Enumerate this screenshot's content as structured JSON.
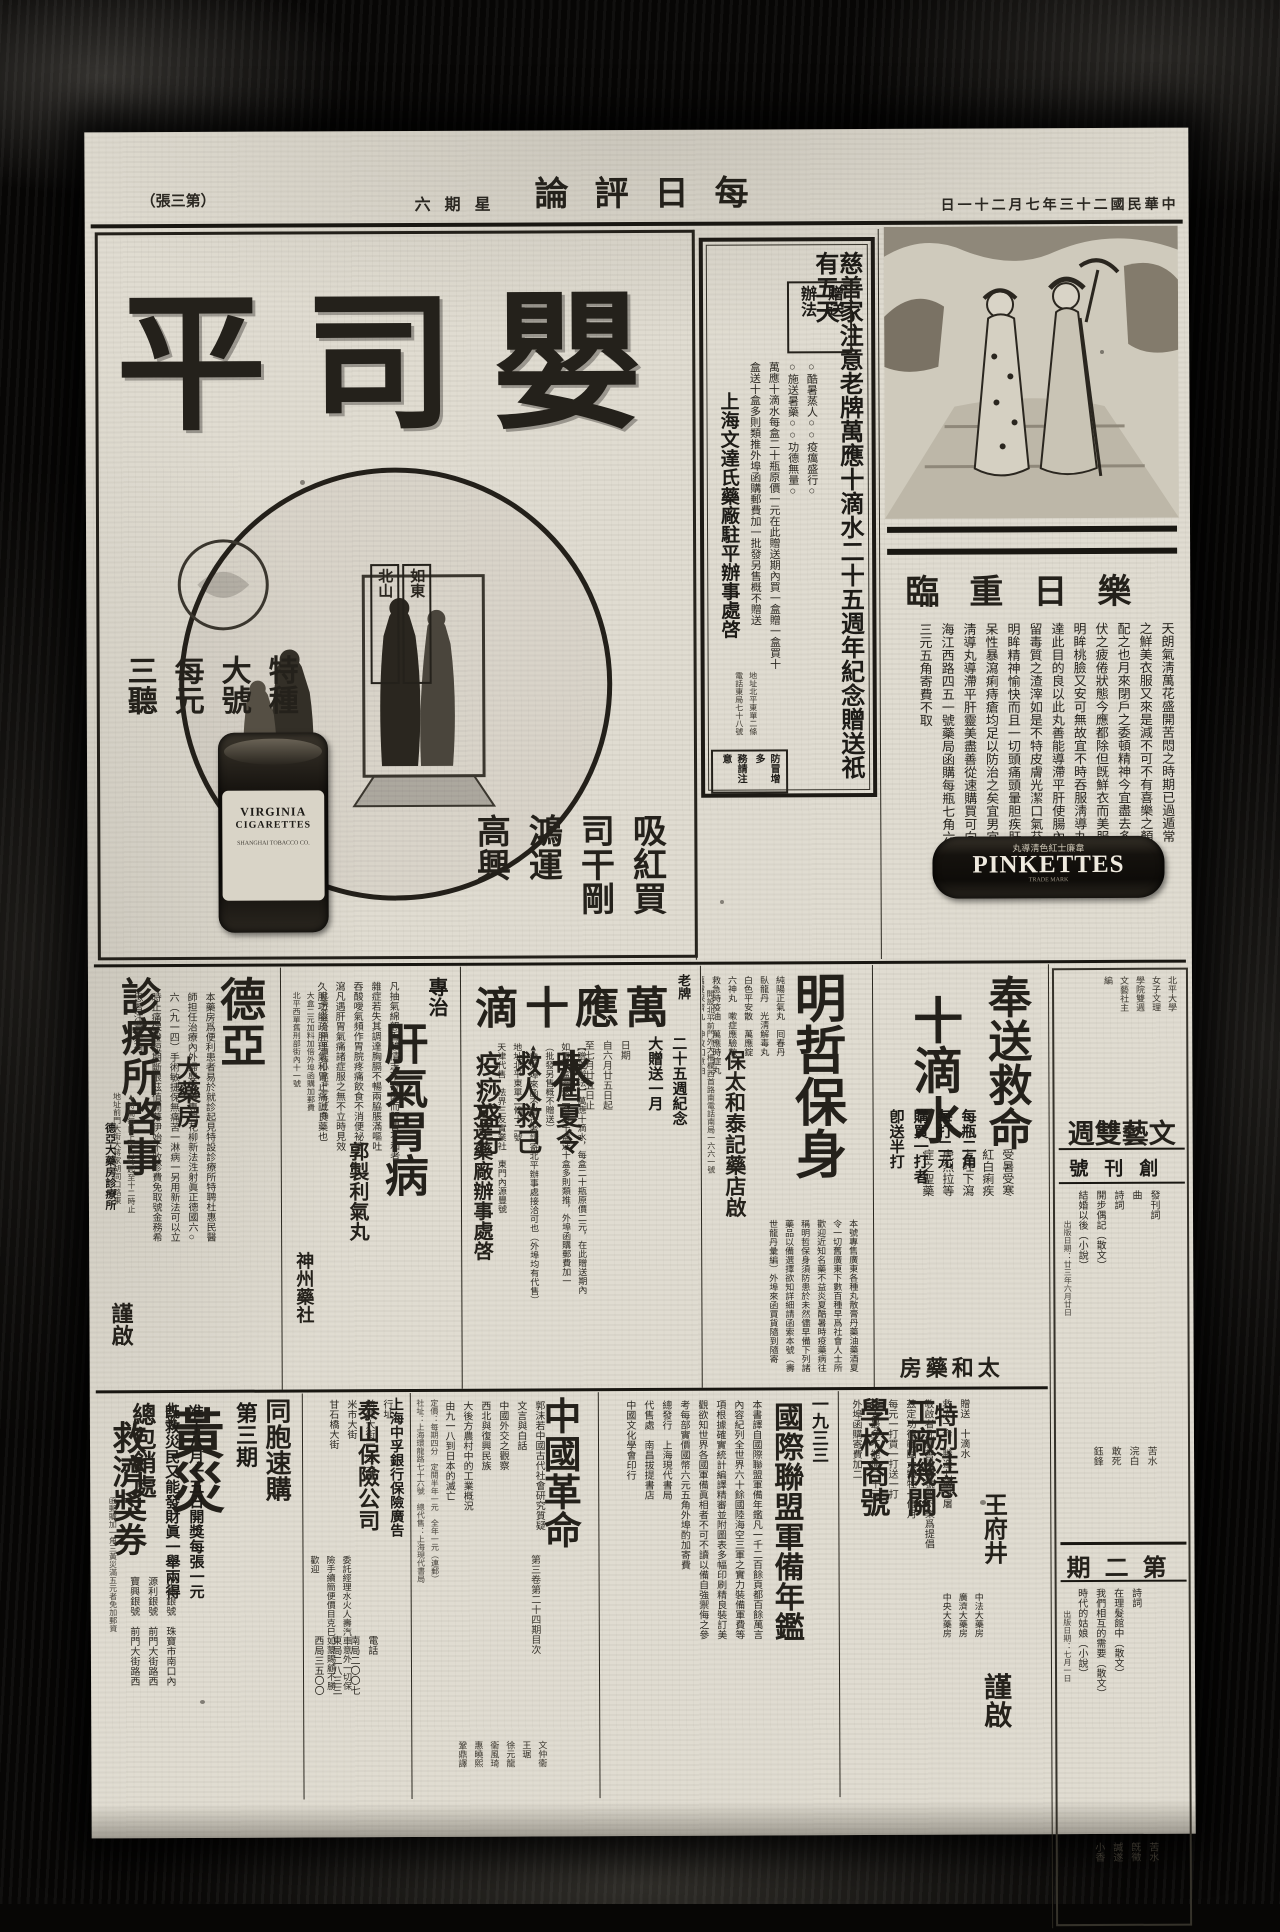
{
  "header": {
    "date": "中華民國二十三年七月二十一日",
    "masthead": "每日評論",
    "weekday": "星期六",
    "sheet": "（第三張）"
  },
  "top": {
    "cig": {
      "brand": "嬰司平",
      "labels": [
        "如東",
        "北山"
      ],
      "slogan": [
        "吸紅買",
        "司干剛",
        "鴻運",
        "高興"
      ],
      "price": [
        "特種",
        "大號",
        "每元",
        "三聽"
      ],
      "tin_line1": "VIRGINIA",
      "tin_line2": "CIGARETTES",
      "tin_line3": "SHANGHAI TOBACCO CO."
    },
    "charity": {
      "headline": "慈善家注意老牌萬應十滴水二十五週年紀念贈送祇有五天",
      "method": [
        "贈送",
        "辦法"
      ],
      "body": [
        "○酷暑蒸人○○疫癘盛行○",
        "○施送暑藥○○功德無量○",
        "萬應十滴水每盒二十瓶原價一元在此贈送期內買一盒贈一盒買十",
        "盒送十盒多則類推外埠函購郵費加一批發另售概不贈送"
      ],
      "signer": "上海文達氏藥廠駐平辦事處啓",
      "addr": [
        "地址北平東單二條",
        "電話東局七十八號"
      ],
      "warn": [
        "防冒增多",
        "務請注意"
      ]
    },
    "pink": {
      "headline": "樂日重臨",
      "body": [
        "天朗氣淸萬花盛開苦悶之時期已過遁常",
        "之鮮美衣服又來是減不可不有喜樂之顏容",
        "配之也月來閉戶之委頓精神今宜盡去多日",
        "伏之疲倦狀態今應都除但旣鮮衣而美服矣",
        "明眸桃臉又安可無故宜不時吞服淸導丸以",
        "達此目的良以此丸善能導滯平肝使腸內不",
        "留毒質之渣滓如是不特皮膚光潔口氣芬芳",
        "明眸精神愉快而且一切頭痛頭暈胆疾肝火",
        "呆性暴瀉痢痔瘡均足以防治之矣宜男宜女",
        "淸導丸導滯平肝靈美盡善從速購買可向上",
        "海江西路四五一號藥局函購每瓶七角六瓶",
        "三元五角寄費不取"
      ],
      "logo_zh": "韋廉士紅色淸導丸",
      "logo": "PINKETTES",
      "trade": "TRADE MARK"
    }
  },
  "mid": {
    "deya": {
      "titles": [
        "德亞",
        "大藥房",
        "診療所啓事"
      ],
      "body": [
        "本藥房爲便利患者易於就診起見特設診療所特聘杜惠民醫",
        "師担任治療內外婦嬰各科專門花柳新法泩射眞正德國六○",
        "六（九一四）手術敏捷保無痛苦一淋病一另用新法可以立",
        "時止痛保證短期斷根茲值開幕伊始不收診費免取號金務希",
        "患者注意是荷"
      ],
      "time_addr": [
        "▲時間每日上午八時起至十二時止",
        "地址前門大街大蔣家胡同口路東"
      ],
      "signer": "德亞大藥房診療所",
      "sign_word": "謹啟"
    },
    "ganwei": {
      "title_small": "專治",
      "title_big": "肝氣胃病",
      "product": "郭製利氣丸",
      "body": [
        "凡抽氣綿怒呑酸情志不舒因而肝胃不和者",
        "雜症若失其調達胸膈不暢兩脇脹滿嘔吐",
        "吞酸噯氣頻作胃脘疼痛飲食不消便祕溏",
        "瀉凡遇肝胃氣痛諸症服之無不立時見效",
        "久服功能疏肝理氣和胃止痛誠良藥也"
      ],
      "seller": [
        "此藥並無分銷定價每小盒洋一元二角",
        "大盒二元加料加倍外埠函購加郵費",
        "北平西單舊刑部街內十一號"
      ],
      "shop": "神州藥社"
    },
    "wanying": {
      "brand_small": "老牌",
      "headline": "萬應十滴水",
      "anniv": [
        "二十五週紀念",
        "大贈送一月"
      ],
      "dates": [
        "日期",
        "自六月廿五日起",
        "至七月廿五日止"
      ],
      "slogans": [
        "時屆夏令",
        "救人救己",
        "疫痧盛行",
        "莫失良機"
      ],
      "method": [
        "【贈送辦法】萬應十滴水，每盒二十瓶原價二元，在此贈送期內",
        "如買一盒贈送二盒買十盒送十盒多則類推，外埠函購郵費加一",
        "（批發另售概不贈送）",
        "▲發外埠來函不贈送者請寄北平辦事處接洽可也（外埠均有代售）",
        "地址北平東單二條十二號",
        "天津代售　法界三友實業社　東門內源豐號"
      ],
      "signer": "文達藥廠辦事處啓"
    },
    "mingzhe": {
      "headline": "明哲保身",
      "body": [
        "本號專售廣東各種丸散膏丹藥油藥酒夏",
        "令一切舊廣東下數百種早爲社會人士所",
        "歡迎近知名藥不益炎夏酷暑時疫藥病往",
        "稱明哲保身須防患於未然儘早備下列諸",
        "藥品以備選擇欲知詳細請函索本號（壽",
        "世龍丹彙編）外埠來函買貨隨到隨寄"
      ],
      "medicines": [
        "純陽正氣丸　囘春丹",
        "臥龍丹　光淸解毒丸",
        "白色平安散　萬應錠",
        "六神丸　嗽症應驗散",
        "救急時疫油　萬應時症丸",
        "萬靈保濟丸　神效如意油"
      ],
      "addr": "開設北平前門外大柵欄西首路南電話南局一六六一號",
      "signer": "保太和泰記藥店啟"
    },
    "fengsong": {
      "headline1": "奉送救命",
      "headline2": "十滴水",
      "body": [
        "受暑受寒",
        "紅白痢疾",
        "上吐下瀉",
        "虎烈拉等",
        "症之聖藥"
      ],
      "offer": [
        "每瓶二角",
        "每打二元",
        "購買一打者",
        "卽送半打"
      ],
      "signer": "太和藥房"
    }
  },
  "bottom": {
    "huangzai": {
      "urge": "同胞速購",
      "issue": "第三期",
      "headline": "黃災",
      "headline2": "救濟獎券",
      "body": [
        "准于八月十五日開獎每張一元",
        "旣救災民又能發財眞一舉兩得"
      ],
      "office_place": "北平",
      "office": "總包銷處",
      "agents": [
        "正通銀號　珠寶市南口內",
        "源利銀號　前門大街路西",
        "寶興銀號　前門大街路西"
      ],
      "mail_note": "函郵購加一角三黃災滿五元者免加郵資"
    },
    "zhongfu": {
      "bank": "上海中孚銀行保險廣告",
      "company": "泰山保險公司",
      "body": [
        "委託經理水火人壽汽車意外一切保",
        "險手續簡便價目克巳如蒙賜顧不勝",
        "歡迎"
      ],
      "addr": [
        "行址",
        "前外大街一六二號",
        "米市大街",
        "甘石橋大街"
      ],
      "phone": [
        "電話",
        "南局二〇〇七",
        "東局二八三三",
        "西局三五〇〇"
      ]
    },
    "geming": {
      "title": "中國革命",
      "vol": "第三卷第二十四期目次",
      "items": [
        "郭沫若中國古代社會研究質疑",
        "文言與白話",
        "中國外交之觀察",
        "西北與復興民族",
        "大後方農村中的工業概況",
        "由九一八到日本的滅亡"
      ],
      "authors": [
        "文仲衞",
        "王琚",
        "徐元龍",
        "衞風琦",
        "惠曉熙",
        "鞏鼎譯"
      ],
      "price": [
        "定價：每期四分　定閱半年一元　全年一元（連郵）",
        "社址：上海環龍路七十六號　總代售：上海現代書局"
      ]
    },
    "nianjian": {
      "year": "一九三三",
      "title": "國際聯盟軍備年鑑",
      "body": [
        "本書譯自國際聯盟軍備年鑑凡一千二百餘頁都百餘萬言",
        "內容紀列全世界六十餘國陸海空三軍之實力裝備軍費等",
        "項根據確實統計編譯精審並附圖表多幅印刷精良裝訂美",
        "觀欲知世界各國軍備眞相者不可不讀以備自強禦侮之參",
        "考每部實價國幣六元五角外埠酌加寄費",
        "總發行　上海現代書局",
        "代售處　南昌拔提書店",
        "中國文化學會印行"
      ]
    },
    "gongchang": {
      "targets": [
        "工廠機關",
        "學校商號"
      ],
      "note": "特別注意",
      "body": [
        "贈送　十滴水",
        "救人一命　勝造七級浮屠",
        "敬啟者凡屬善擧本號無不樂爲提倡",
        "茲定功德範圍大犧牲一個月",
        "每元一打買一打送一打",
        "每人最多不能逾二十元",
        "外埠函購寄費加二"
      ],
      "place": "王府井",
      "pharmacies": [
        "中法大藥房",
        "廣濟大藥房",
        "中央大藥房"
      ],
      "sign": "謹啟"
    }
  },
  "rail": {
    "publisher": [
      "北平大學",
      "女子文理",
      "學院雙週",
      "文藝社主",
      "編"
    ],
    "title": "文藝雙週",
    "issue1": "創刊號",
    "issue1_items": [
      "發刊詞",
      "曲",
      "詩詞",
      "開步偶記（散文）",
      "結婚以後（小說）"
    ],
    "issue1_authors": [
      "苦水",
      "浣白",
      "敢死",
      "鈺鋒"
    ],
    "issue1_date": "出版日期：廿三年六月廿日",
    "issue2": "第二期",
    "issue2_items": [
      "詩詞",
      "在理髮館中（散文）",
      "我們相互的需要（散文）",
      "時代的姑娘（小說）"
    ],
    "issue2_authors": [
      "苦水",
      "旣徵",
      "諴遂",
      "小香"
    ],
    "issue2_date": "出版日期：七月一日"
  },
  "colors": {
    "paper": "#e0dcd1",
    "ink": "#1d1b17",
    "heavy": "#0b0a08"
  }
}
